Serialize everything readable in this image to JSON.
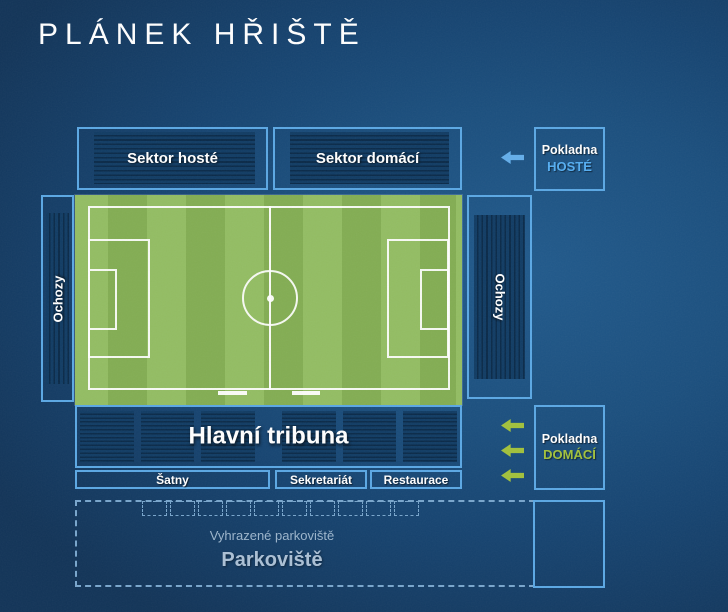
{
  "title": "PLÁNEK HŘIŠTĚ",
  "stands": {
    "sektor_hoste": "Sektor hosté",
    "sektor_domaci": "Sektor domácí",
    "ochozy_left": "Ochozy",
    "ochozy_right": "Ochozy",
    "hlavni_tribuna": "Hlavní tribuna",
    "tribuna_block_count": 6
  },
  "facilities": {
    "satny": "Šatny",
    "sekretariat": "Sekretariát",
    "restaurace": "Restaurace"
  },
  "ticket_offices": {
    "hoste": {
      "line1": "Pokladna",
      "line2": "HOSTÉ"
    },
    "domaci": {
      "line1": "Pokladna",
      "line2": "DOMÁCÍ"
    }
  },
  "parking": {
    "reserved_label": "Vyhrazené parkoviště",
    "label": "Parkoviště",
    "space_count": 10
  },
  "icons": {
    "guest_entrance_arrow": "arrow-left",
    "home_entrance_arrow": "arrow-left",
    "home_entrance_arrow_count": 3
  },
  "colors": {
    "accent": "#5ba8e4",
    "arrow_blue": "#64aeea",
    "arrow_green": "#a2c13c",
    "hoste_text": "#55aef2",
    "domaci_text": "#a2c13c",
    "pitch_light": "#93bd63",
    "pitch_dark": "#83ad53",
    "panel_base": "#113c64",
    "panel_line": "#0a2a49",
    "parking_line": "#79a6cc",
    "parking_text": "#9cb5cc",
    "parking_title": "#abc0d5"
  }
}
